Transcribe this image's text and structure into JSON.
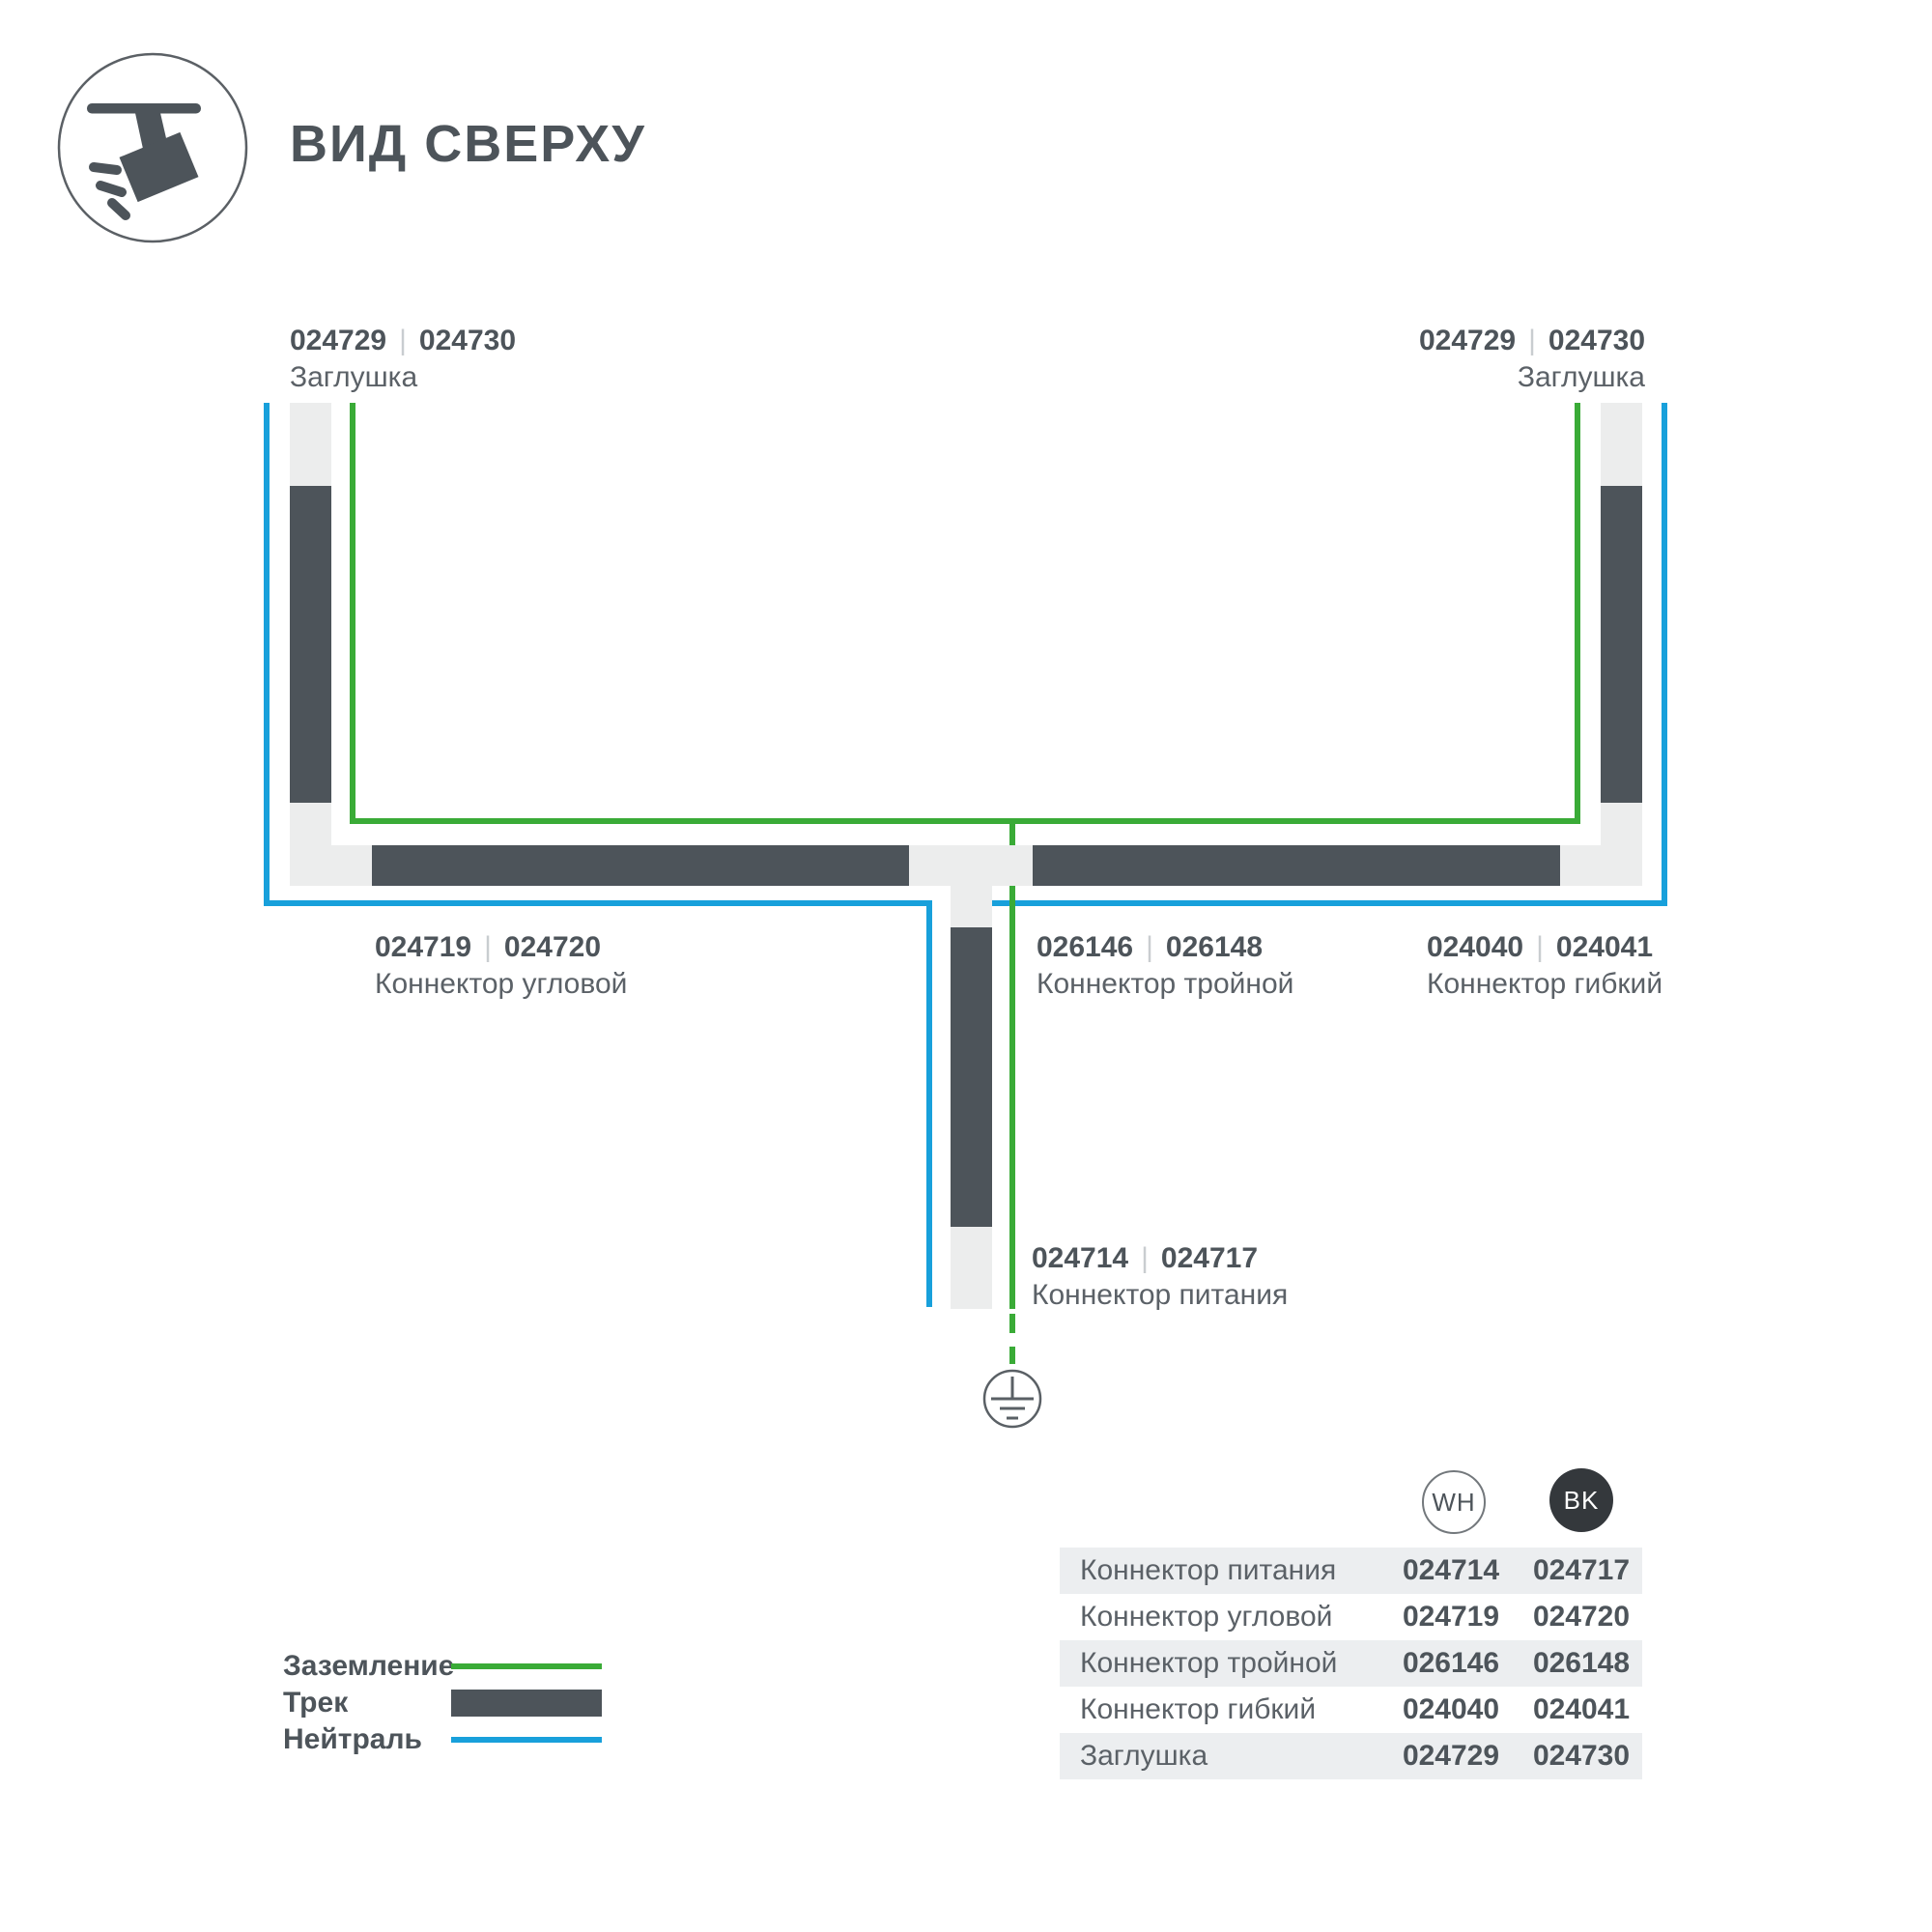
{
  "header": {
    "title": "ВИД СВЕРХУ"
  },
  "separator": "|",
  "colors": {
    "ground": "#3aab37",
    "neutral": "#18a0db",
    "track": "#4d545a",
    "connector": "#eceded"
  },
  "callouts": {
    "endcap_left": {
      "wh": "024729",
      "bk": "024730",
      "name": "Заглушка"
    },
    "endcap_right": {
      "wh": "024729",
      "bk": "024730",
      "name": "Заглушка"
    },
    "corner": {
      "wh": "024719",
      "bk": "024720",
      "name": "Коннектор угловой"
    },
    "triple": {
      "wh": "026146",
      "bk": "026148",
      "name": "Коннектор тройной"
    },
    "flex": {
      "wh": "024040",
      "bk": "024041",
      "name": "Коннектор гибкий"
    },
    "power": {
      "wh": "024714",
      "bk": "024717",
      "name": "Коннектор питания"
    }
  },
  "legend": {
    "items": [
      {
        "label": "Заземление",
        "type": "ground"
      },
      {
        "label": "Трек",
        "type": "track"
      },
      {
        "label": "Нейтраль",
        "type": "neutral"
      }
    ]
  },
  "table": {
    "columns": [
      {
        "label": "WH"
      },
      {
        "label": "BK"
      }
    ],
    "rows": [
      {
        "name": "Коннектор питания",
        "wh": "024714",
        "bk": "024717"
      },
      {
        "name": "Коннектор угловой",
        "wh": "024719",
        "bk": "024720"
      },
      {
        "name": "Коннектор тройной",
        "wh": "026146",
        "bk": "026148"
      },
      {
        "name": "Коннектор гибкий",
        "wh": "024040",
        "bk": "024041"
      },
      {
        "name": "Заглушка",
        "wh": "024729",
        "bk": "024730"
      }
    ]
  }
}
